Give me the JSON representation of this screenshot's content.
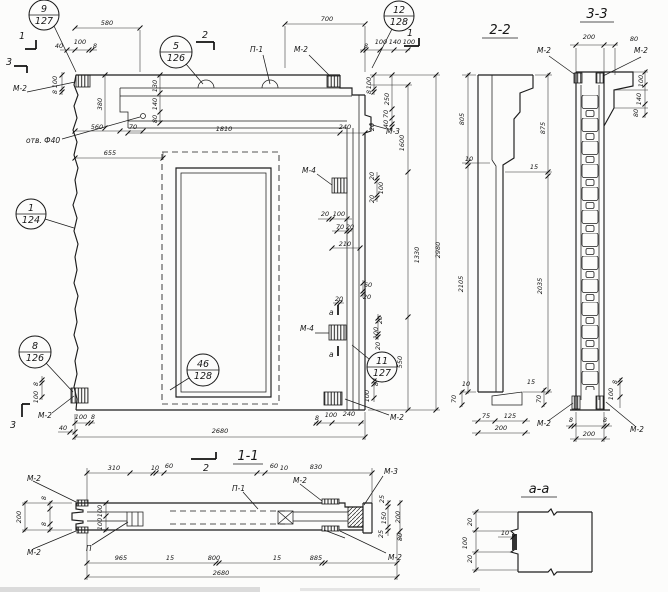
{
  "colors": {
    "ink": "#1c1c1c",
    "paper": "#fcfcfb"
  },
  "titles": {
    "s22": "2-2",
    "s33": "3-3",
    "s11": "1-1",
    "aa": "а-а"
  },
  "callouts": {
    "c9": {
      "num": "9",
      "sheet": "127"
    },
    "c5": {
      "num": "5",
      "sheet": "126"
    },
    "c12": {
      "num": "12",
      "sheet": "128"
    },
    "c1": {
      "num": "1",
      "sheet": "124"
    },
    "c8": {
      "num": "8",
      "sheet": "126"
    },
    "c46": {
      "num": "46",
      "sheet": "128"
    },
    "c11": {
      "num": "11",
      "sheet": "127"
    }
  },
  "section_marks": {
    "one": "1",
    "two": "2",
    "three": "3"
  },
  "markers": {
    "m2": "М-2",
    "m3": "М-3",
    "m4": "М-4",
    "p1": "П-1",
    "p": "П",
    "a": "а",
    "hole": "отв. Ф40"
  },
  "dims": {
    "main": [
      "580",
      "40",
      "100",
      "8",
      "700",
      "8",
      "100",
      "140",
      "100",
      "100",
      "8",
      "380",
      "130",
      "140",
      "80",
      "560",
      "70",
      "655",
      "1810",
      "240",
      "100",
      "8",
      "250",
      "70",
      "40",
      "20",
      "1600",
      "20",
      "100",
      "70",
      "20",
      "210",
      "20",
      "100",
      "20",
      "1330",
      "2980",
      "60",
      "20",
      "20",
      "20",
      "100",
      "20",
      "550",
      "8",
      "100",
      "8",
      "100",
      "240",
      "2680",
      "40",
      "100",
      "8",
      "8",
      "100"
    ],
    "s22": [
      "805",
      "10",
      "2105",
      "875",
      "15",
      "2035",
      "10",
      "70",
      "15",
      "70",
      "75",
      "125",
      "200"
    ],
    "s33": [
      "200",
      "80",
      "100",
      "140",
      "80",
      "8",
      "100",
      "8",
      "8",
      "200"
    ],
    "s11": [
      "8",
      "200",
      "8",
      "310",
      "10",
      "60",
      "60",
      "10",
      "830",
      "100",
      "100",
      "25",
      "150",
      "25",
      "200",
      "80",
      "965",
      "15",
      "800",
      "15",
      "885",
      "2680"
    ],
    "aa": [
      "20",
      "100",
      "20",
      "10"
    ]
  }
}
